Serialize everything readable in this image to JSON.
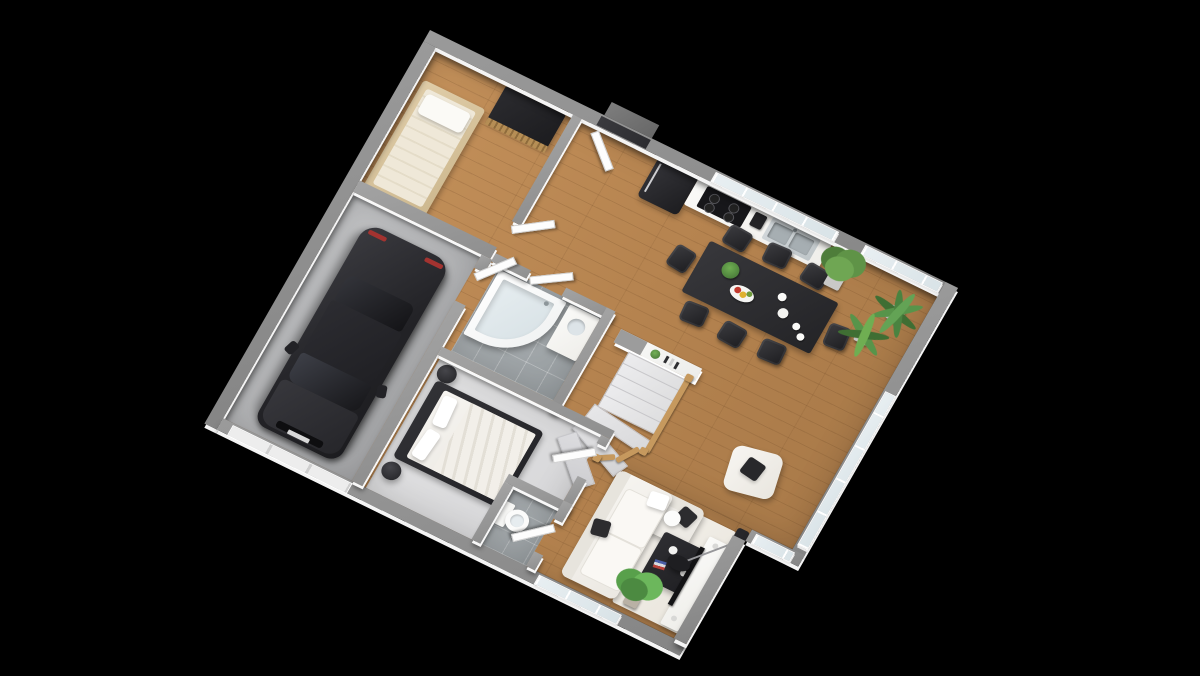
{
  "scene": {
    "title": "Ground-floor 3D floor plan (isometric render)",
    "view": "isometric top-down, plan rotated about 26 degrees",
    "background_color": "#000000",
    "text_visible": "none"
  },
  "colors": {
    "background": "#000000",
    "exterior_wall_cap": "#8d8d8d",
    "wall_face_white": "#f4f4f4",
    "wood_floor": "#b5834f",
    "garage_concrete": "#b5b6b8",
    "bathroom_tile": "#a2a7aa",
    "bedroom_carpet": "#dcdcde",
    "window_glass": "#dfe9ed",
    "dark_furniture": "#2a2a2e",
    "white_furniture": "#f4f2ee",
    "oak_railing": "#c6995e",
    "plant_green": "#5f9347",
    "fruit_red": "#c23a2e",
    "fruit_yellow": "#dfb12f"
  },
  "rooms": [
    {
      "id": "garage",
      "label": "Garage",
      "furniture": [
        "dark sedan car",
        "sectional garage door"
      ]
    },
    {
      "id": "small-bedroom",
      "label": "Small bedroom",
      "furniture": [
        "single bed with white pillow",
        "black wardrobe with oak slat front"
      ]
    },
    {
      "id": "entry-hall",
      "label": "Entrance hall",
      "furniture": [
        "front door opening",
        "open white doors to garage, small bedroom and bathroom",
        "outside step"
      ]
    },
    {
      "id": "kitchen",
      "label": "Kitchen",
      "furniture": [
        "black retro fridge",
        "white counter",
        "black cooktop",
        "coffee machine",
        "stainless double sink",
        "window above counter"
      ]
    },
    {
      "id": "bathroom",
      "label": "Bathroom",
      "furniture": [
        "white corner bathtub",
        "vanity with washbasin"
      ]
    },
    {
      "id": "wc",
      "label": "WC",
      "furniture": [
        "toilet"
      ]
    },
    {
      "id": "bedroom",
      "label": "Bedroom",
      "furniture": [
        "double bed, dark frame, white duvet, two pillows",
        "two black round bedside stools"
      ]
    },
    {
      "id": "living-dining",
      "label": "Living / dining room",
      "furniture": [
        "dark dining table for 8 with black chairs",
        "fruit bowl, plant and white vases on table",
        "winder staircase with oak balustrade",
        "white console pony-wall with decor",
        "white L-shaped sofa with black cushions",
        "white armchair with black cushion",
        "black coffee table on cream rug",
        "white round side table",
        "TV cabinet with flat TV on south-east wall",
        "black arc floor lamp",
        "bushy potted plant near kitchen",
        "two potted palms in east corner",
        "potted plant at south windows"
      ]
    }
  ],
  "openings": {
    "windows": [
      "north wall above kitchen counter",
      "north wall near dining corner",
      "east wall window band",
      "corner step-wall window",
      "south wall double window"
    ],
    "doors": [
      "front entrance (north)",
      "garage door (south)",
      "5 interior white doors"
    ]
  }
}
